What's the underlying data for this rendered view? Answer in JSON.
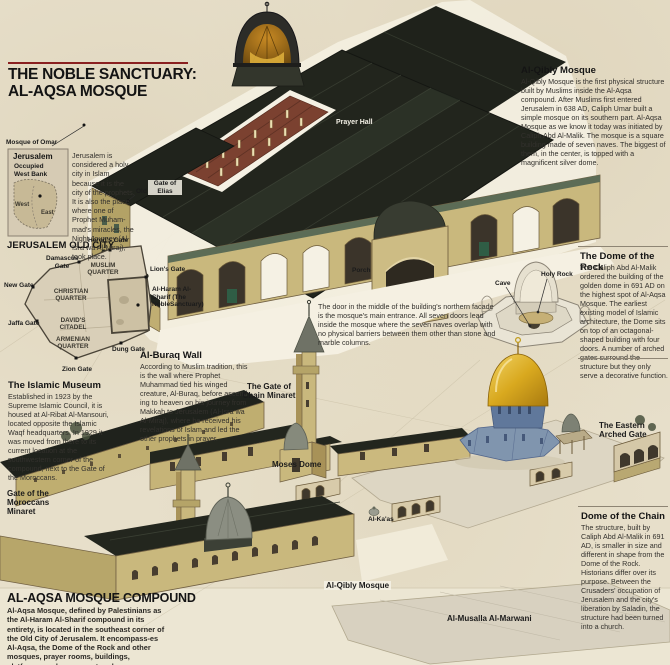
{
  "header": {
    "title_line1": "THE NOBLE SANCTUARY:",
    "title_line2": "AL-AQSA MOSQUE"
  },
  "jerusalem_inset": {
    "pointer_label": "Mosque of Omar",
    "map_title": "Jerusalem",
    "region_label": "Occupied West Bank",
    "old_city_label": "Old City",
    "west_label": "West",
    "east_label": "East",
    "caption": "Jerusalem is considered a holy city in Islam because it is the city of the prophets. It is also the place where one of Prophet Muham-mad's miracles, the Night Journey (Al-Isra wa Al-Miraj), took place."
  },
  "old_city_map": {
    "title": "JERUSALEM OLD CITY",
    "gates": {
      "herods": "Herod's Gate",
      "damascus": "Damascus Gate",
      "new": "New Gate",
      "lions": "Lion's Gate",
      "jaffa": "Jaffa Gate",
      "dung": "Dung Gate",
      "zion": "Zion Gate"
    },
    "quarters": {
      "muslim": "MUSLIM QUARTER",
      "christian": "CHRISTIAN QUARTER",
      "davids": "DAVID'S CITADEL",
      "armenian": "ARMENIAN QUARTER"
    },
    "haram_label": "Al-Haram Al-Sharif (The NobleSanctuary)"
  },
  "sections": {
    "al_qibly": {
      "title": "Al-Qibly Mosque",
      "body": "Al-Qibly Mosque is the first physical structure built by Muslims inside the Al-Aqsa compound. After Muslims first entered Jerusalem in 638 AD, Caliph Umar built a simple mosque on its southern part. Al-Aqsa Mosque as we know it today was initiated by Caliph Abd Al-Malik. The mosque is a square building made of seven naves. The biggest of them, in the center, is topped with a magnificent silver dome."
    },
    "dome_of_rock": {
      "title": "The Dome of the Rock",
      "body": "The Caliph Abd Al-Malik ordered the building of the golden dome in 691 AD on the highest spot of Al-Aqsa Mosque. The earliest existing model of Islamic architecture, the Dome sits on top of an octagonal-shaped building with four doors. A number of arched gates surround the structure but they only serve a decorative function."
    },
    "door_note": {
      "body": "The door in the middle of the building's northern facade is the mosque's main entrance. All seven doors lead inside the mosque where the seven naves overlap with no physical barriers between them other than stone and marble columns."
    },
    "al_buraq_wall": {
      "title": "Al-Buraq Wall",
      "body": "According to Muslim tradition, this is the wall where Prophet Muhammad tied his winged creature, Al-Buraq, before ascend-ing to heaven on his journey from Makkah to Jerusalem (Al-Isra wa Al-Miraj), where he received his revelations of Islam and led the other prophets in prayer."
    },
    "islamic_museum": {
      "title": "The Islamic Museum",
      "body": "Established in 1923 by the Supreme Islamic Council, it is housed at Al-Ribat Al-Mansouri, located opposite the Islamic Waqf headquarters. In 1929 it was moved from there to its current location at the southwestern corner of the compound, next to the Gate of the Moroccans."
    },
    "dome_of_chain": {
      "title": "Dome of the Chain",
      "body": "The structure, built by Caliph Abd Al-Malik in 691 AD, is smaller in size and different in shape from the Dome of the Rock. Historians differ over its purpose. Between the Crusaders' occupation of Jerusalem and the city's liberation by Saladin, the structure had been turned into a church."
    },
    "compound": {
      "title": "AL-AQSA MOSQUE COMPOUND",
      "body": "Al-Aqsa Mosque, defined by Palestinians as the Al-Haram Al-Sharif compound in its entirety, is located in the southeast corner of the Old City of Jerusalem. It encompass-es Al-Aqsa, the Dome of the Rock and other mosques, prayer rooms, buildings, platforms, and open courtyards."
    }
  },
  "labels": {
    "prayer_hall": "Prayer Hall",
    "gate_of_elias": "Gate of Elias",
    "porch": "Porch",
    "holy_rock": "Holy Rock",
    "cave": "Cave",
    "chain_minaret": "The Gate of Chain Minaret",
    "moses_dome": "Moses Dome",
    "eastern_gate": "The Eastern Arched Gate",
    "moroccans_minaret": "Gate of the Moroccans Minaret",
    "al_kaas": "Al-Ka'as",
    "al_qibly_bottom": "Al-Qibly Mosque",
    "al_musalla": "Al-Musalla Al-Marwani"
  },
  "colors": {
    "parchment": "#e7dfca",
    "parchment_light": "#ece6d4",
    "ink": "#1c1c1c",
    "accent_red": "#8a2020",
    "wall_tan": "#c9b87d",
    "roof_dark": "#23261e",
    "dome_gold": "#d9a91f",
    "dome_blue": "#7e93ac",
    "carpet_red": "#7b4130"
  }
}
